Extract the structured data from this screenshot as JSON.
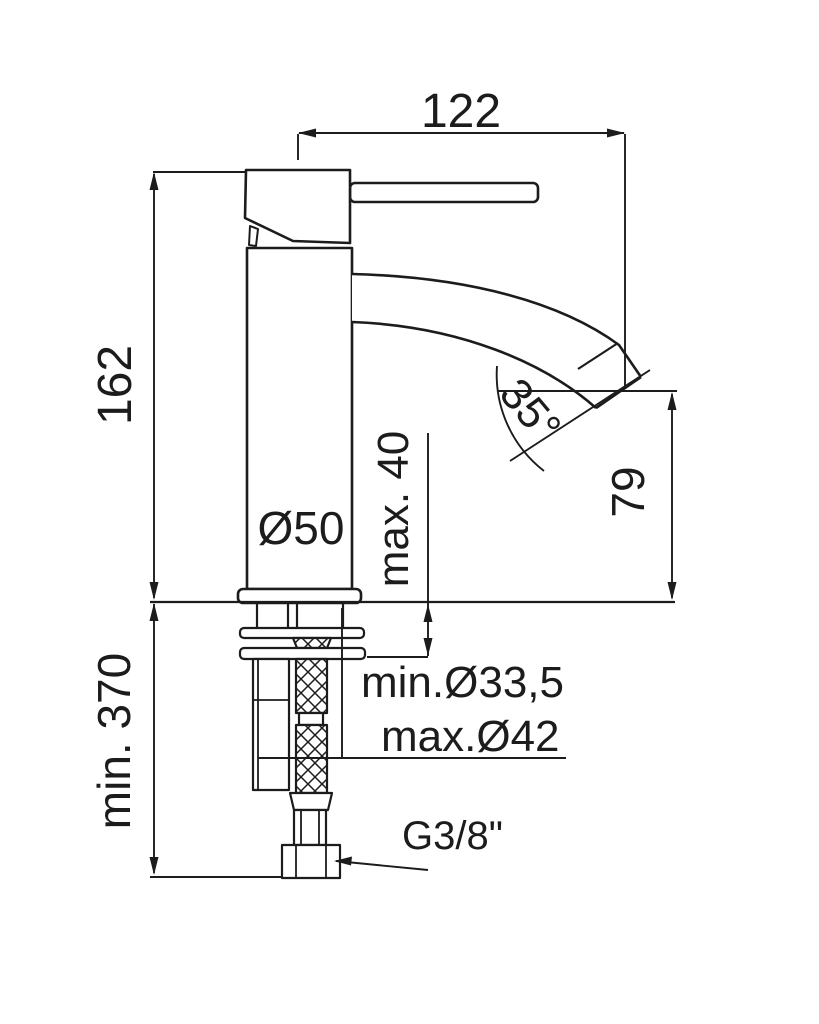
{
  "drawing": {
    "kind": "single-lever basin mixer tap installation diagram",
    "labels": {
      "spout_reach": "122",
      "height_above_deck": "162",
      "min_clearance_below": "min. 370",
      "max_deck_thickness": "max. 40",
      "body_diameter": "Ø50",
      "outlet_height": "79",
      "outlet_angle": "35°",
      "hole_min_diameter": "min.Ø33,5",
      "hole_max_diameter": "max.Ø42",
      "connection_thread": "G3/8\""
    }
  },
  "colors": {
    "line": "#1c1c1c",
    "text": "#1c1c1c",
    "background": "#ffffff"
  }
}
